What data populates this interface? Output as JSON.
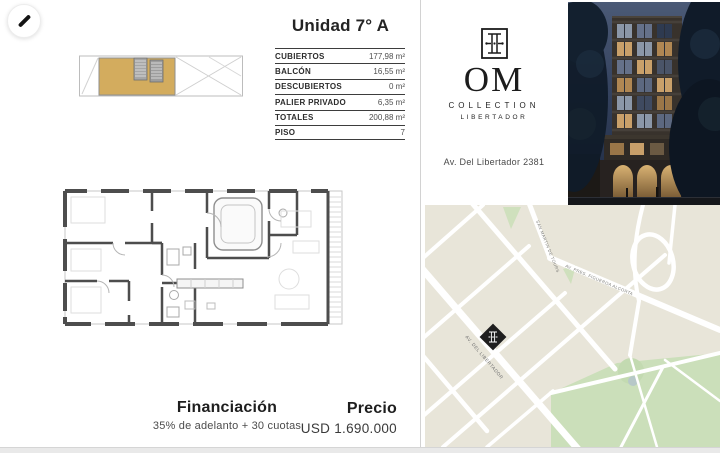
{
  "unit": {
    "title": "Unidad 7° A"
  },
  "specs": {
    "rows": [
      {
        "label": "CUBIERTOS",
        "value": "177,98 m²"
      },
      {
        "label": "BALCÓN",
        "value": "16,55 m²"
      },
      {
        "label": "DESCUBIERTOS",
        "value": "0 m²"
      },
      {
        "label": "PALIER PRIVADO",
        "value": "6,35 m²"
      },
      {
        "label": "TOTALES",
        "value": "200,88 m²"
      },
      {
        "label": "PISO",
        "value": "7"
      }
    ]
  },
  "brand": {
    "name": "OM",
    "collection": "COLLECTION",
    "line": "LIBERTADOR",
    "address": "Av. Del Libertador 2381"
  },
  "financing": {
    "title": "Financiación",
    "terms": "35% de adelanto + 30 cuotas"
  },
  "price": {
    "label": "Precio",
    "amount": "USD 1.690.000"
  },
  "map": {
    "street_labels": {
      "upper_left": "SAN MARTIN DE TOURS",
      "upper_right": "AV. PRES. FIGUEROA ALCORTA",
      "main": "AV. DEL LIBERTADOR"
    }
  },
  "icons": {
    "edit": "pencil-icon",
    "marker": "om-emblem-diamond"
  },
  "colors": {
    "unit_highlight_tan": "#d3ac5e",
    "map_background": "#e8e5d9",
    "map_green": "#cbdfba",
    "marker_black": "#1f1f1f",
    "wall_gray": "#4d4d4d"
  }
}
